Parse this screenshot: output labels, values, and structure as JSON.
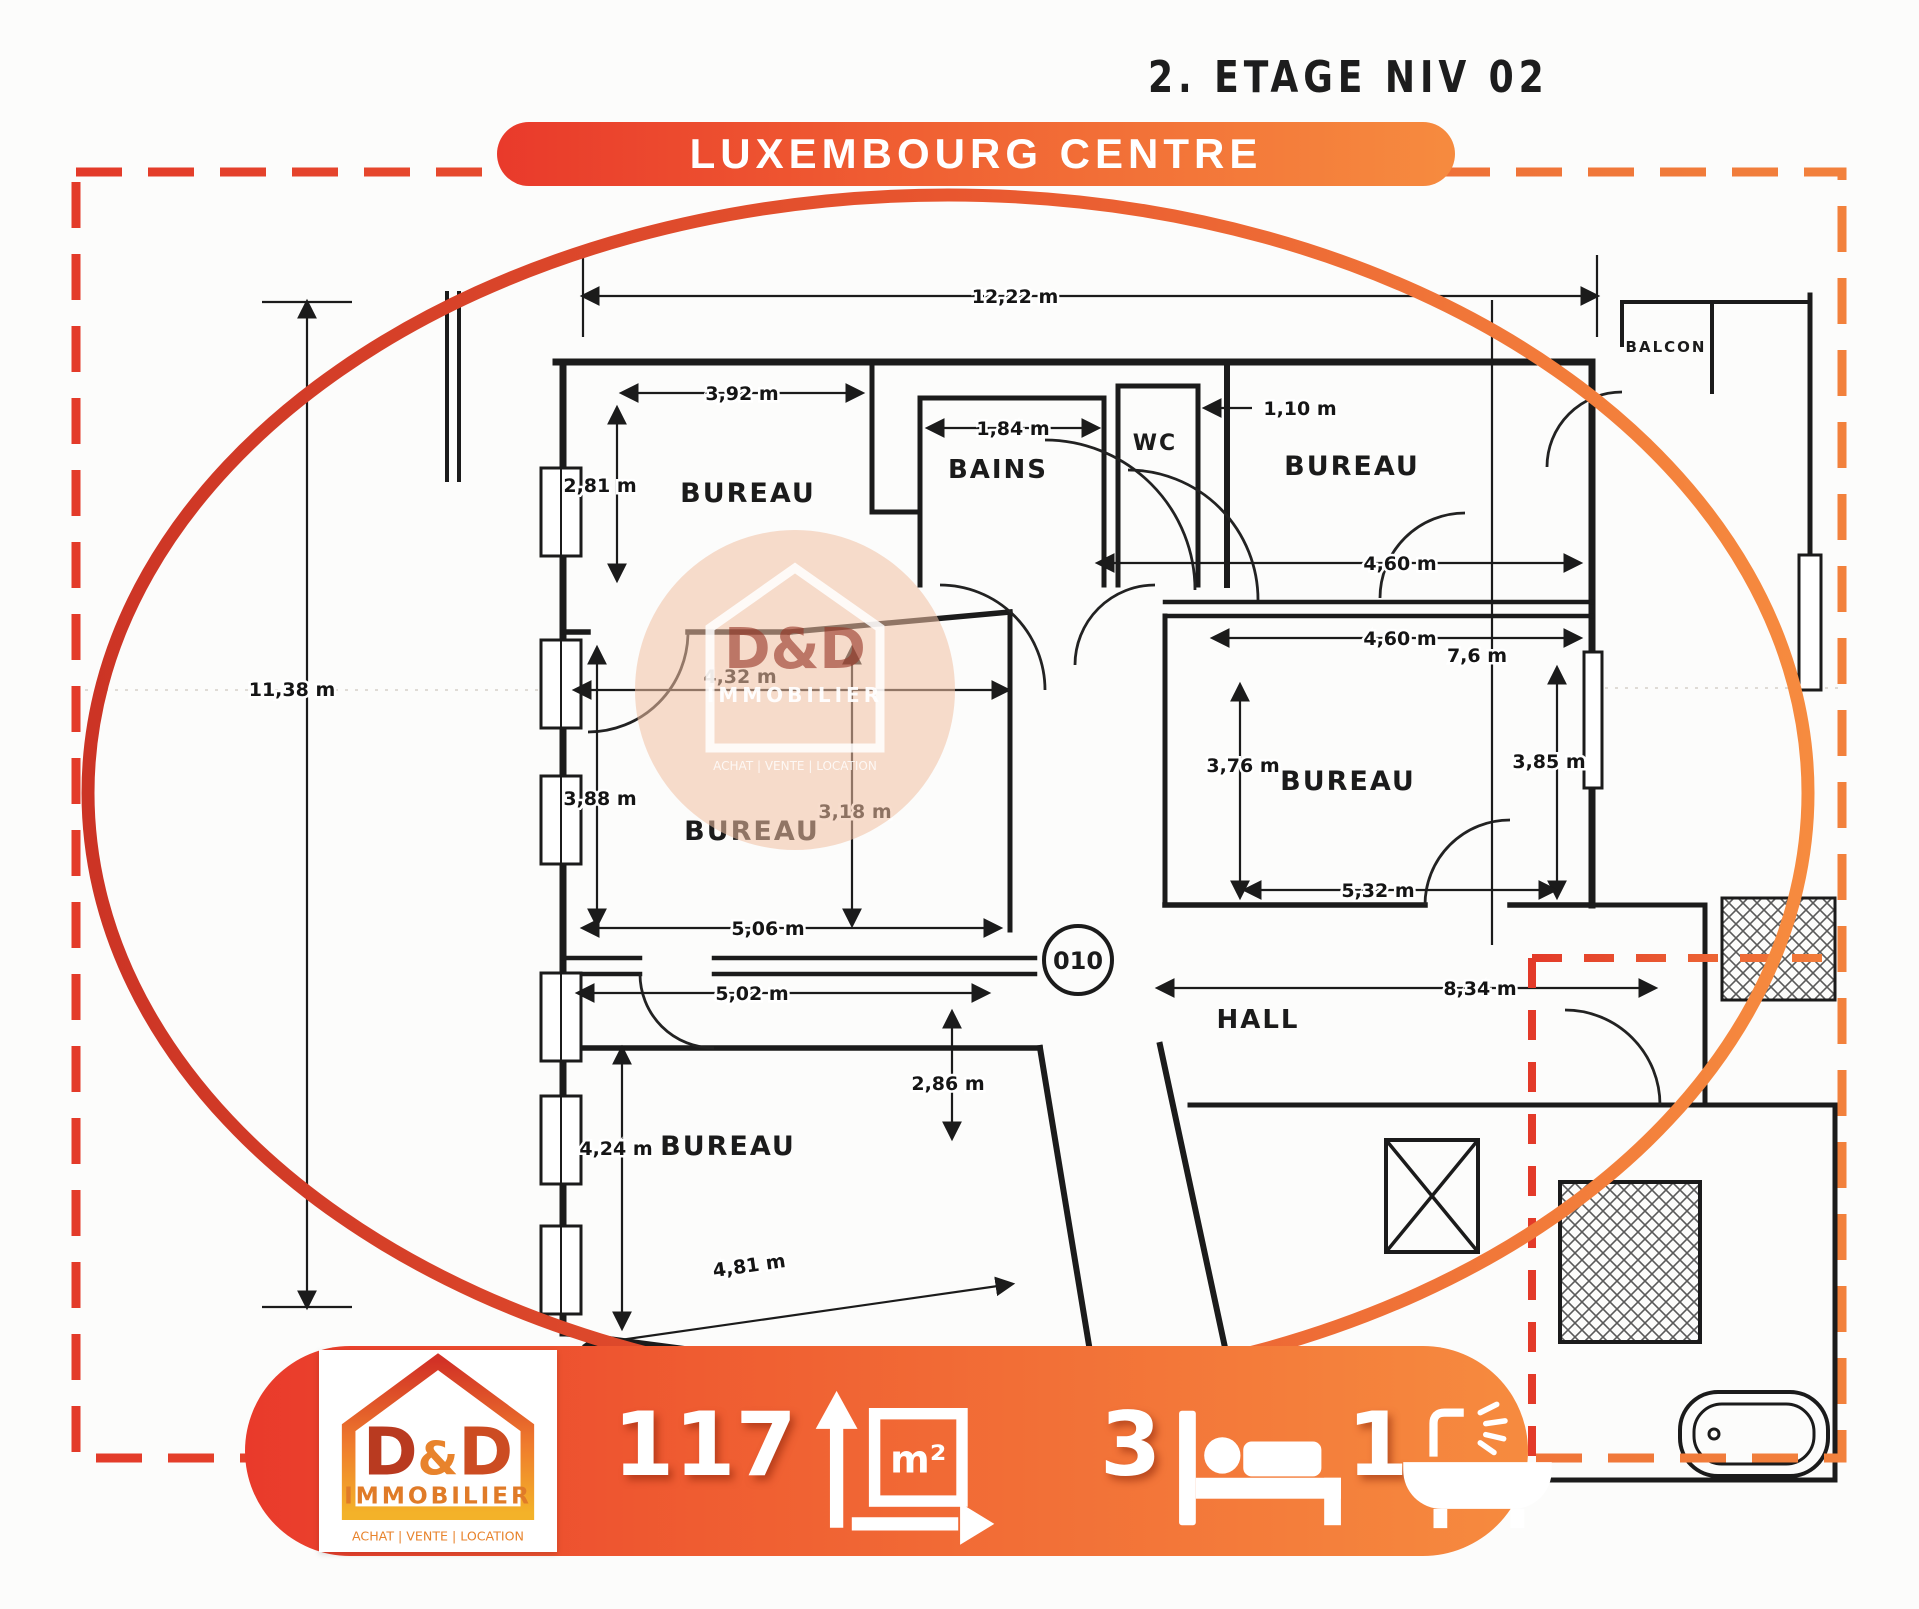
{
  "page": {
    "floor_title": "2. ETAGE NIV 02",
    "banner_label": "LUXEMBOURG CENTRE"
  },
  "colors": {
    "gradient_start": "#e93a2b",
    "gradient_end": "#f68b3f",
    "ink": "#1b1b1b"
  },
  "plan": {
    "unit_badge": "010",
    "triangle_label": "A",
    "rooms": [
      {
        "label": "BUREAU"
      },
      {
        "label": "BAINS"
      },
      {
        "label": "WC"
      },
      {
        "label": "BUREAU"
      },
      {
        "label": "BUREAU"
      },
      {
        "label": "BUREAU"
      },
      {
        "label": "HALL"
      },
      {
        "label": "BUREAU"
      },
      {
        "label": "BALCON"
      }
    ],
    "dims": [
      {
        "text": "12,22 m"
      },
      {
        "text": "3,92 m"
      },
      {
        "text": "1,84 m"
      },
      {
        "text": "1,10 m"
      },
      {
        "text": "2,81 m"
      },
      {
        "text": "4,60 m"
      },
      {
        "text": "4,60 m"
      },
      {
        "text": "7,6 m"
      },
      {
        "text": "4,32 m"
      },
      {
        "text": "3,88 m"
      },
      {
        "text": "3,18 m"
      },
      {
        "text": "3,76 m"
      },
      {
        "text": "3,85 m"
      },
      {
        "text": "5,32 m"
      },
      {
        "text": "5,06 m"
      },
      {
        "text": "5,02 m"
      },
      {
        "text": "11,38 m"
      },
      {
        "text": "8,34 m"
      },
      {
        "text": "2,86 m"
      },
      {
        "text": "4,24 m"
      },
      {
        "text": "4,81 m"
      }
    ]
  },
  "watermark": {
    "brand": "D&D",
    "subtitle": "IMMOBILIER",
    "tagline": "ACHAT  |  VENTE  |  LOCATION"
  },
  "footer": {
    "area_value": "117",
    "area_unit": "m²",
    "bedrooms": "3",
    "bathrooms": "1",
    "logo": {
      "d1": "D",
      "amp": "&",
      "d2": "D",
      "subtitle": "IMMOBILIER",
      "tagline": "ACHAT  |  VENTE  |  LOCATION"
    }
  }
}
